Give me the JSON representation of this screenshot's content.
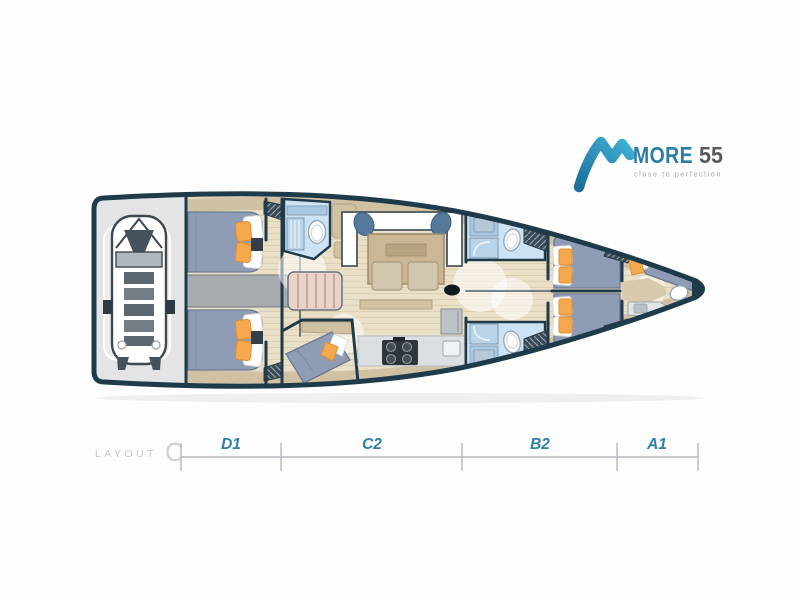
{
  "brand": {
    "name": "MORE",
    "model": "55",
    "tagline": "close to perfection"
  },
  "layout": {
    "word": "LAYOUT",
    "variant": "C"
  },
  "dimensions": {
    "sections": [
      {
        "label": "D1"
      },
      {
        "label": "C2"
      },
      {
        "label": "B2"
      },
      {
        "label": "A1"
      }
    ]
  },
  "colors": {
    "hull": "#1f3b4a",
    "floor": "#eadfc7",
    "plank": "#dccfb3",
    "bed": "#8e9db5",
    "cushion": "#f5a84d",
    "bath": "#cde2f2",
    "bathdeep": "#a9c9e2",
    "tan": "#cfc1a1",
    "graystrip": "#a7acb0",
    "garage": "#e3e4e5",
    "counter": "#dcdfe1",
    "brand": "#2a7da5",
    "brandgray": "#57585a",
    "taggray": "#a3a7ab",
    "labelblue": "#2d80a6",
    "dimline": "#b5babd",
    "layoutgray": "#c5c7c9"
  }
}
